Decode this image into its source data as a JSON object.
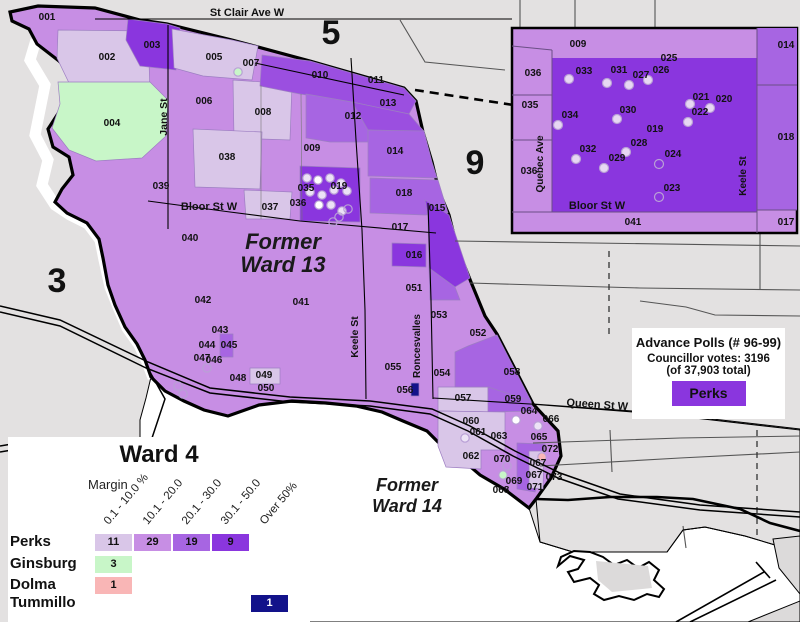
{
  "colors": {
    "bg": "#e3e1e1",
    "water": "#ffffff",
    "col1": "#d9c6e8",
    "col2": "#c78ee4",
    "col3": "#a765e2",
    "col35": "#9b4fe0",
    "col4": "#8a36de",
    "green": "#c8f6c8",
    "pink": "#f9b6b6",
    "navy": "#12128a",
    "lav": "#ece2f6",
    "white": "#ffffff",
    "road": "#4d4d4d",
    "insetdot": "#e7d7f3"
  },
  "map": {
    "ward_outline": "38,6 95,8 140,20 167,24 232,40 310,61 404,88 416,101 423,132 432,162 439,191 449,215 457,247 471,282 485,316 497,334 533,404 558,431 561,456 551,478 536,499 529,508 504,489 480,475 458,456 438,442 427,431 403,421 382,412 356,406 326,403 292,401 259,405 228,416 204,410 184,401 165,391 151,377 145,360 137,344 125,327 115,305 108,285 103,258 99,239 87,223 67,213 55,202 62,189 73,175 69,157 53,147 48,129 61,109 75,95 77,77 59,61 37,44 29,29 12,21 10,12",
    "river_path": "36,40 30,60 45,85 40,110 35,135 48,160 42,185 55,205 70,215 88,224 100,240 104,260 110,287 118,307 127,328 139,345 147,362 153,378",
    "river_blob": "150,330 176,340 190,360 196,380 185,395 165,388 150,370",
    "lake_poly": "151,377 165,391 204,410 228,416 259,405 292,401 326,403 356,406 382,412 403,421 427,431 458,456 480,475 504,489 529,508 540,542 573,552 667,552 683,530 705,527 745,536 800,548 800,622 140,622 140,420 146,398",
    "land_poly": "533,404 660,413 800,429 800,548 775,545 745,536 705,527 683,530 667,552 573,552 540,542 536,499 551,478 561,456 558,431",
    "regions": [
      {
        "id": "002",
        "fill": "col1",
        "points": "58,30 148,31 150,92 96,95 70,85 57,58"
      },
      {
        "id": "003",
        "fill": "col4",
        "points": "128,19 167,24 180,28 176,70 140,66 126,40"
      },
      {
        "id": "005",
        "fill": "col1",
        "points": "172,29 232,40 258,46 252,80 203,76 174,68"
      },
      {
        "id": "004",
        "fill": "green",
        "points": "58,82 150,82 168,100 166,136 142,158 96,161 69,150 52,128 60,104"
      },
      {
        "id": "008",
        "fill": "col1",
        "points": "233,80 292,84 290,140 234,138"
      },
      {
        "id": "038",
        "fill": "col1",
        "points": "193,129 262,132 260,189 195,187"
      },
      {
        "id": "037",
        "fill": "col1",
        "points": "244,190 292,192 290,219 246,219"
      },
      {
        "id": "010-011",
        "fill": "col35",
        "points": "262,55 310,61 404,88 416,101 409,114 352,102 300,94 260,86"
      },
      {
        "id": "013",
        "fill": "col35",
        "points": "352,102 409,114 421,128 424,131 398,132 368,130 352,120"
      },
      {
        "id": "012",
        "fill": "col3",
        "points": "306,94 352,102 368,130 368,142 330,142 306,138"
      },
      {
        "id": "014",
        "fill": "col3",
        "points": "368,130 424,131 432,162 437,178 368,176"
      },
      {
        "id": "018",
        "fill": "col3",
        "points": "370,178 438,180 448,213 425,215 370,213"
      },
      {
        "id": "015",
        "fill": "col4",
        "points": "425,200 449,215 470,278 455,287 429,268 428,216"
      },
      {
        "id": "016",
        "fill": "col4",
        "points": "392,243 426,244 426,267 392,266"
      },
      {
        "id": "051b",
        "fill": "col3",
        "points": "429,268 455,287 460,300 430,300"
      },
      {
        "id": "019",
        "fill": "col4",
        "points": "300,166 360,168 360,222 300,221"
      },
      {
        "id": "045",
        "fill": "col3",
        "points": "220,334 233,334 233,357 220,357"
      },
      {
        "id": "049",
        "fill": "col1",
        "points": "250,368 280,368 280,384 250,384"
      },
      {
        "id": "057",
        "fill": "col1",
        "points": "438,387 490,387 490,412 438,411"
      },
      {
        "id": "058",
        "fill": "col3",
        "points": "455,352 468,346 497,335 531,401 488,401 488,387 455,387"
      },
      {
        "id": "059",
        "fill": "col3",
        "points": "488,387 531,401 533,411 488,412"
      },
      {
        "id": "060-063",
        "fill": "col1",
        "points": "438,411 505,412 505,450 481,450 481,469 446,467 438,446"
      },
      {
        "id": "072-073",
        "fill": "col3",
        "points": "517,443 545,444 542,470 535,492 517,489"
      },
      {
        "id": "067",
        "fill": "col1",
        "points": "529,451 544,451 543,489 529,488"
      },
      {
        "id": "056",
        "fill": "navy",
        "points": "411,383 419,383 419,396 411,396"
      }
    ],
    "roads_black": [
      "95,19 512,19",
      "168,25 168,229",
      "351,58 356,140 362,230 365,310 366,399",
      "148,201 230,212 300,221 436,233",
      "428,203 431,300 433,399",
      "433,398 530,404 660,414 800,430",
      "255,63 404,95"
    ],
    "roads_thin": [
      "261,85 261,219",
      "301,94 302,220"
    ],
    "roads_gray": [
      "520,0 520,28",
      "400,20 425,62 505,70",
      "455,241 800,246",
      "470,283 640,288 800,290",
      "760,233 760,290",
      "640,301 686,307 715,315 800,316",
      "533,443 680,438 800,436",
      "540,466 680,458 800,452",
      "610,430 612,472",
      "683,526 686,548",
      "655,0 655,28",
      "575,0 575,28"
    ],
    "dashed_black": "M415,90 C480,100 560,112 640,124 S760,136 800,141",
    "dashed_gray": [
      "609,251 609,334",
      "757,430 757,540"
    ],
    "rails": [
      "0,306 60,320 148,362 210,388 290,397 370,401 432,409 470,426 515,451 560,473 620,494 700,505 800,512",
      "0,312 60,326 146,368 210,393 290,402 370,406 430,414 468,431 513,456 558,478 618,499 700,510 800,517",
      "150,372 165,399 152,438 128,472"
    ],
    "lakeshore": "536,499 568,500 610,497 657,497 693,499 740,509 770,523 800,531",
    "shoreline": "540,542 573,552 667,552 683,530 705,527 745,536 775,545 800,549",
    "island_outline": "558,566 570,556 584,560 578,569 568,572 574,582 590,578 599,585 594,594 604,600 619,596 634,600 647,594 659,597 664,589 654,580 659,570 649,562 638,568 627,560 614,565 603,557 590,552 574,551 561,557",
    "island_patch": "596,561 648,566 652,588 612,592 598,580",
    "breakwater": [
      "676,622 764,572",
      "690,622 776,580",
      "756,562 770,578"
    ],
    "right_grays": [
      "773,539 800,536 800,594 779,568",
      "748,622 800,601 800,622"
    ],
    "equals_ticks": [
      "0,446 12,444",
      "0,452 12,450"
    ],
    "dots": [
      {
        "x": 307,
        "y": 178,
        "f": "lav"
      },
      {
        "x": 318,
        "y": 180,
        "f": "white"
      },
      {
        "x": 330,
        "y": 178,
        "f": "lav"
      },
      {
        "x": 341,
        "y": 183,
        "f": "lav"
      },
      {
        "x": 347,
        "y": 191,
        "f": "lav"
      },
      {
        "x": 334,
        "y": 190,
        "f": "lav"
      },
      {
        "x": 322,
        "y": 195,
        "f": "lav"
      },
      {
        "x": 310,
        "y": 192,
        "f": "lav"
      },
      {
        "x": 319,
        "y": 205,
        "f": "white"
      },
      {
        "x": 331,
        "y": 205,
        "f": "lav"
      },
      {
        "x": 342,
        "y": 211,
        "f": "lav"
      },
      {
        "x": 339,
        "y": 217,
        "f": "none"
      },
      {
        "x": 348,
        "y": 209,
        "f": "none"
      },
      {
        "x": 333,
        "y": 222,
        "f": "none"
      },
      {
        "x": 238,
        "y": 72,
        "f": "green"
      },
      {
        "x": 465,
        "y": 438,
        "f": "lav"
      },
      {
        "x": 516,
        "y": 420,
        "f": "white"
      },
      {
        "x": 538,
        "y": 426,
        "f": "lav"
      },
      {
        "x": 542,
        "y": 457,
        "f": "pink"
      },
      {
        "x": 503,
        "y": 475,
        "f": "green"
      },
      {
        "x": 507,
        "y": 466,
        "f": "none"
      },
      {
        "x": 178,
        "y": 386,
        "f": "none"
      },
      {
        "x": 183,
        "y": 394,
        "f": "none"
      },
      {
        "x": 207,
        "y": 368,
        "f": "none"
      }
    ],
    "poll_labels": [
      {
        "t": "001",
        "x": 47,
        "y": 20
      },
      {
        "t": "002",
        "x": 107,
        "y": 60
      },
      {
        "t": "003",
        "x": 152,
        "y": 48
      },
      {
        "t": "004",
        "x": 112,
        "y": 126
      },
      {
        "t": "005",
        "x": 214,
        "y": 60
      },
      {
        "t": "006",
        "x": 204,
        "y": 104
      },
      {
        "t": "007",
        "x": 251,
        "y": 66
      },
      {
        "t": "008",
        "x": 263,
        "y": 115
      },
      {
        "t": "009",
        "x": 312,
        "y": 151
      },
      {
        "t": "010",
        "x": 320,
        "y": 78
      },
      {
        "t": "011",
        "x": 376,
        "y": 83
      },
      {
        "t": "012",
        "x": 353,
        "y": 119
      },
      {
        "t": "013",
        "x": 388,
        "y": 106
      },
      {
        "t": "014",
        "x": 395,
        "y": 154
      },
      {
        "t": "015",
        "x": 437,
        "y": 211
      },
      {
        "t": "016",
        "x": 414,
        "y": 258
      },
      {
        "t": "017",
        "x": 400,
        "y": 230
      },
      {
        "t": "018",
        "x": 404,
        "y": 196
      },
      {
        "t": "019",
        "x": 339,
        "y": 189
      },
      {
        "t": "035",
        "x": 306,
        "y": 191
      },
      {
        "t": "036",
        "x": 298,
        "y": 206
      },
      {
        "t": "037",
        "x": 270,
        "y": 210
      },
      {
        "t": "038",
        "x": 227,
        "y": 160
      },
      {
        "t": "039",
        "x": 161,
        "y": 189
      },
      {
        "t": "040",
        "x": 190,
        "y": 241
      },
      {
        "t": "041",
        "x": 301,
        "y": 305
      },
      {
        "t": "042",
        "x": 203,
        "y": 303
      },
      {
        "t": "043",
        "x": 220,
        "y": 333
      },
      {
        "t": "044",
        "x": 207,
        "y": 348
      },
      {
        "t": "045",
        "x": 229,
        "y": 348
      },
      {
        "t": "046",
        "x": 214,
        "y": 363
      },
      {
        "t": "047",
        "x": 202,
        "y": 361
      },
      {
        "t": "048",
        "x": 238,
        "y": 381
      },
      {
        "t": "049",
        "x": 264,
        "y": 378
      },
      {
        "t": "050",
        "x": 266,
        "y": 391
      },
      {
        "t": "051",
        "x": 414,
        "y": 291
      },
      {
        "t": "052",
        "x": 478,
        "y": 336
      },
      {
        "t": "053",
        "x": 439,
        "y": 318
      },
      {
        "t": "054",
        "x": 442,
        "y": 376
      },
      {
        "t": "055",
        "x": 393,
        "y": 370
      },
      {
        "t": "056",
        "x": 405,
        "y": 393
      },
      {
        "t": "057",
        "x": 463,
        "y": 401
      },
      {
        "t": "058",
        "x": 512,
        "y": 375
      },
      {
        "t": "059",
        "x": 513,
        "y": 402
      },
      {
        "t": "060",
        "x": 471,
        "y": 424
      },
      {
        "t": "061",
        "x": 478,
        "y": 435
      },
      {
        "t": "062",
        "x": 471,
        "y": 459
      },
      {
        "t": "063",
        "x": 499,
        "y": 439
      },
      {
        "t": "064",
        "x": 529,
        "y": 414
      },
      {
        "t": "065",
        "x": 539,
        "y": 440
      },
      {
        "t": "066",
        "x": 551,
        "y": 422
      },
      {
        "t": "067",
        "x": 538,
        "y": 466
      },
      {
        "t": "067",
        "x": 534,
        "y": 478
      },
      {
        "t": "068",
        "x": 501,
        "y": 493
      },
      {
        "t": "069",
        "x": 514,
        "y": 484
      },
      {
        "t": "070",
        "x": 502,
        "y": 462
      },
      {
        "t": "071",
        "x": 535,
        "y": 490
      },
      {
        "t": "072",
        "x": 550,
        "y": 452
      },
      {
        "t": "073",
        "x": 554,
        "y": 480
      }
    ],
    "street_labels": [
      {
        "t": "St Clair Ave W",
        "x": 247,
        "y": 16,
        "r": 0,
        "s": 11
      },
      {
        "t": "Jane St",
        "x": 167,
        "y": 117,
        "r": -90,
        "s": 10.5
      },
      {
        "t": "Bloor St W",
        "x": 209,
        "y": 210,
        "r": 0,
        "s": 11
      },
      {
        "t": "Keele St",
        "x": 358,
        "y": 337,
        "r": -90,
        "s": 10.5
      },
      {
        "t": "Roncesvalles",
        "x": 420,
        "y": 346,
        "r": -90,
        "s": 10
      },
      {
        "t": "Queen St W",
        "x": 597,
        "y": 408,
        "r": 4,
        "s": 11
      }
    ],
    "big_labels": [
      {
        "t": "3",
        "x": 57,
        "y": 292
      },
      {
        "t": "5",
        "x": 331,
        "y": 44
      },
      {
        "t": "9",
        "x": 475,
        "y": 174
      }
    ],
    "area_labels": [
      {
        "t": "Former",
        "x": 283,
        "y": 249,
        "s": 22
      },
      {
        "t": "Ward 13",
        "x": 283,
        "y": 272,
        "s": 22
      },
      {
        "t": "Former",
        "x": 407,
        "y": 491,
        "s": 18
      },
      {
        "t": "Ward 14",
        "x": 407,
        "y": 512,
        "s": 18
      }
    ]
  },
  "inset": {
    "frame": {
      "x": 512,
      "y": 28,
      "w": 285,
      "h": 205
    },
    "rects": [
      {
        "id": "block",
        "fill": "col4",
        "x": 552,
        "y": 58,
        "w": 205,
        "h": 154
      },
      {
        "id": "014",
        "fill": "col3",
        "x": 757,
        "y": 28,
        "w": 40,
        "h": 57
      },
      {
        "id": "018",
        "fill": "col3",
        "x": 757,
        "y": 85,
        "w": 40,
        "h": 125
      }
    ],
    "lines": [
      "552,50 552,212",
      "512,46 552,50",
      "512,95 552,95",
      "512,140 552,140",
      "512,212 757,212",
      "757,28 757,233",
      "757,85 797,85",
      "757,210 797,210"
    ],
    "dots": [
      {
        "x": 569,
        "y": 79,
        "f": 1
      },
      {
        "x": 607,
        "y": 83,
        "f": 1
      },
      {
        "x": 629,
        "y": 85,
        "f": 1
      },
      {
        "x": 648,
        "y": 80,
        "f": 1
      },
      {
        "x": 690,
        "y": 104,
        "f": 1
      },
      {
        "x": 710,
        "y": 108,
        "f": 1
      },
      {
        "x": 688,
        "y": 122,
        "f": 1
      },
      {
        "x": 617,
        "y": 119,
        "f": 1
      },
      {
        "x": 558,
        "y": 125,
        "f": 1
      },
      {
        "x": 576,
        "y": 159,
        "f": 1
      },
      {
        "x": 604,
        "y": 168,
        "f": 1
      },
      {
        "x": 626,
        "y": 152,
        "f": 1
      },
      {
        "x": 659,
        "y": 164,
        "f": 0
      },
      {
        "x": 659,
        "y": 197,
        "f": 0
      }
    ],
    "poll_labels": [
      {
        "t": "009",
        "x": 578,
        "y": 47
      },
      {
        "t": "036",
        "x": 533,
        "y": 76
      },
      {
        "t": "035",
        "x": 530,
        "y": 108
      },
      {
        "t": "036",
        "x": 529,
        "y": 174
      },
      {
        "t": "033",
        "x": 584,
        "y": 74
      },
      {
        "t": "031",
        "x": 619,
        "y": 73
      },
      {
        "t": "027",
        "x": 641,
        "y": 78
      },
      {
        "t": "025",
        "x": 669,
        "y": 61
      },
      {
        "t": "026",
        "x": 661,
        "y": 73
      },
      {
        "t": "021",
        "x": 701,
        "y": 100
      },
      {
        "t": "020",
        "x": 724,
        "y": 102
      },
      {
        "t": "022",
        "x": 700,
        "y": 115
      },
      {
        "t": "030",
        "x": 628,
        "y": 113
      },
      {
        "t": "034",
        "x": 570,
        "y": 118
      },
      {
        "t": "019",
        "x": 655,
        "y": 132
      },
      {
        "t": "028",
        "x": 639,
        "y": 146
      },
      {
        "t": "032",
        "x": 588,
        "y": 152
      },
      {
        "t": "029",
        "x": 617,
        "y": 161
      },
      {
        "t": "024",
        "x": 673,
        "y": 157
      },
      {
        "t": "023",
        "x": 672,
        "y": 191
      },
      {
        "t": "014",
        "x": 786,
        "y": 48
      },
      {
        "t": "018",
        "x": 786,
        "y": 140
      },
      {
        "t": "041",
        "x": 633,
        "y": 225
      },
      {
        "t": "017",
        "x": 786,
        "y": 225
      }
    ],
    "street_labels": [
      {
        "t": "Quebec Ave",
        "x": 543,
        "y": 164,
        "r": -90,
        "s": 10
      },
      {
        "t": "Keele St",
        "x": 746,
        "y": 176,
        "r": -90,
        "s": 10
      },
      {
        "t": "Bloor St W",
        "x": 597,
        "y": 209,
        "r": 0,
        "s": 11
      }
    ]
  },
  "legend": {
    "title": "Ward 4",
    "margin_label": "Margin",
    "columns": [
      "0.1 - 10.0 %",
      "10.1 - 20.0",
      "20.1 - 30.0",
      "30.1 - 50.0",
      "Over 50%"
    ],
    "col_x": [
      87,
      126,
      165,
      204,
      243
    ],
    "rows": [
      {
        "name": "Perks",
        "y": 97,
        "cells": [
          {
            "col": 0,
            "value": "11",
            "fill": "col1"
          },
          {
            "col": 1,
            "value": "29",
            "fill": "col2"
          },
          {
            "col": 2,
            "value": "19",
            "fill": "col3"
          },
          {
            "col": 3,
            "value": "9",
            "fill": "col4"
          }
        ]
      },
      {
        "name": "Ginsburg",
        "y": 119,
        "cells": [
          {
            "col": 0,
            "value": "3",
            "fill": "green"
          }
        ]
      },
      {
        "name": "Dolma",
        "y": 140,
        "cells": [
          {
            "col": 0,
            "value": "1",
            "fill": "pink"
          }
        ]
      },
      {
        "name": "Tummillo",
        "y": 158,
        "cells": [
          {
            "col": 4,
            "value": "1",
            "fill": "navy",
            "light": true
          }
        ]
      }
    ]
  },
  "advance": {
    "title": "Advance Polls (# 96-99)",
    "votes_line": "Councillor votes: 3196",
    "total_line": "(of 37,903 total)",
    "swatch_label": "Perks"
  }
}
